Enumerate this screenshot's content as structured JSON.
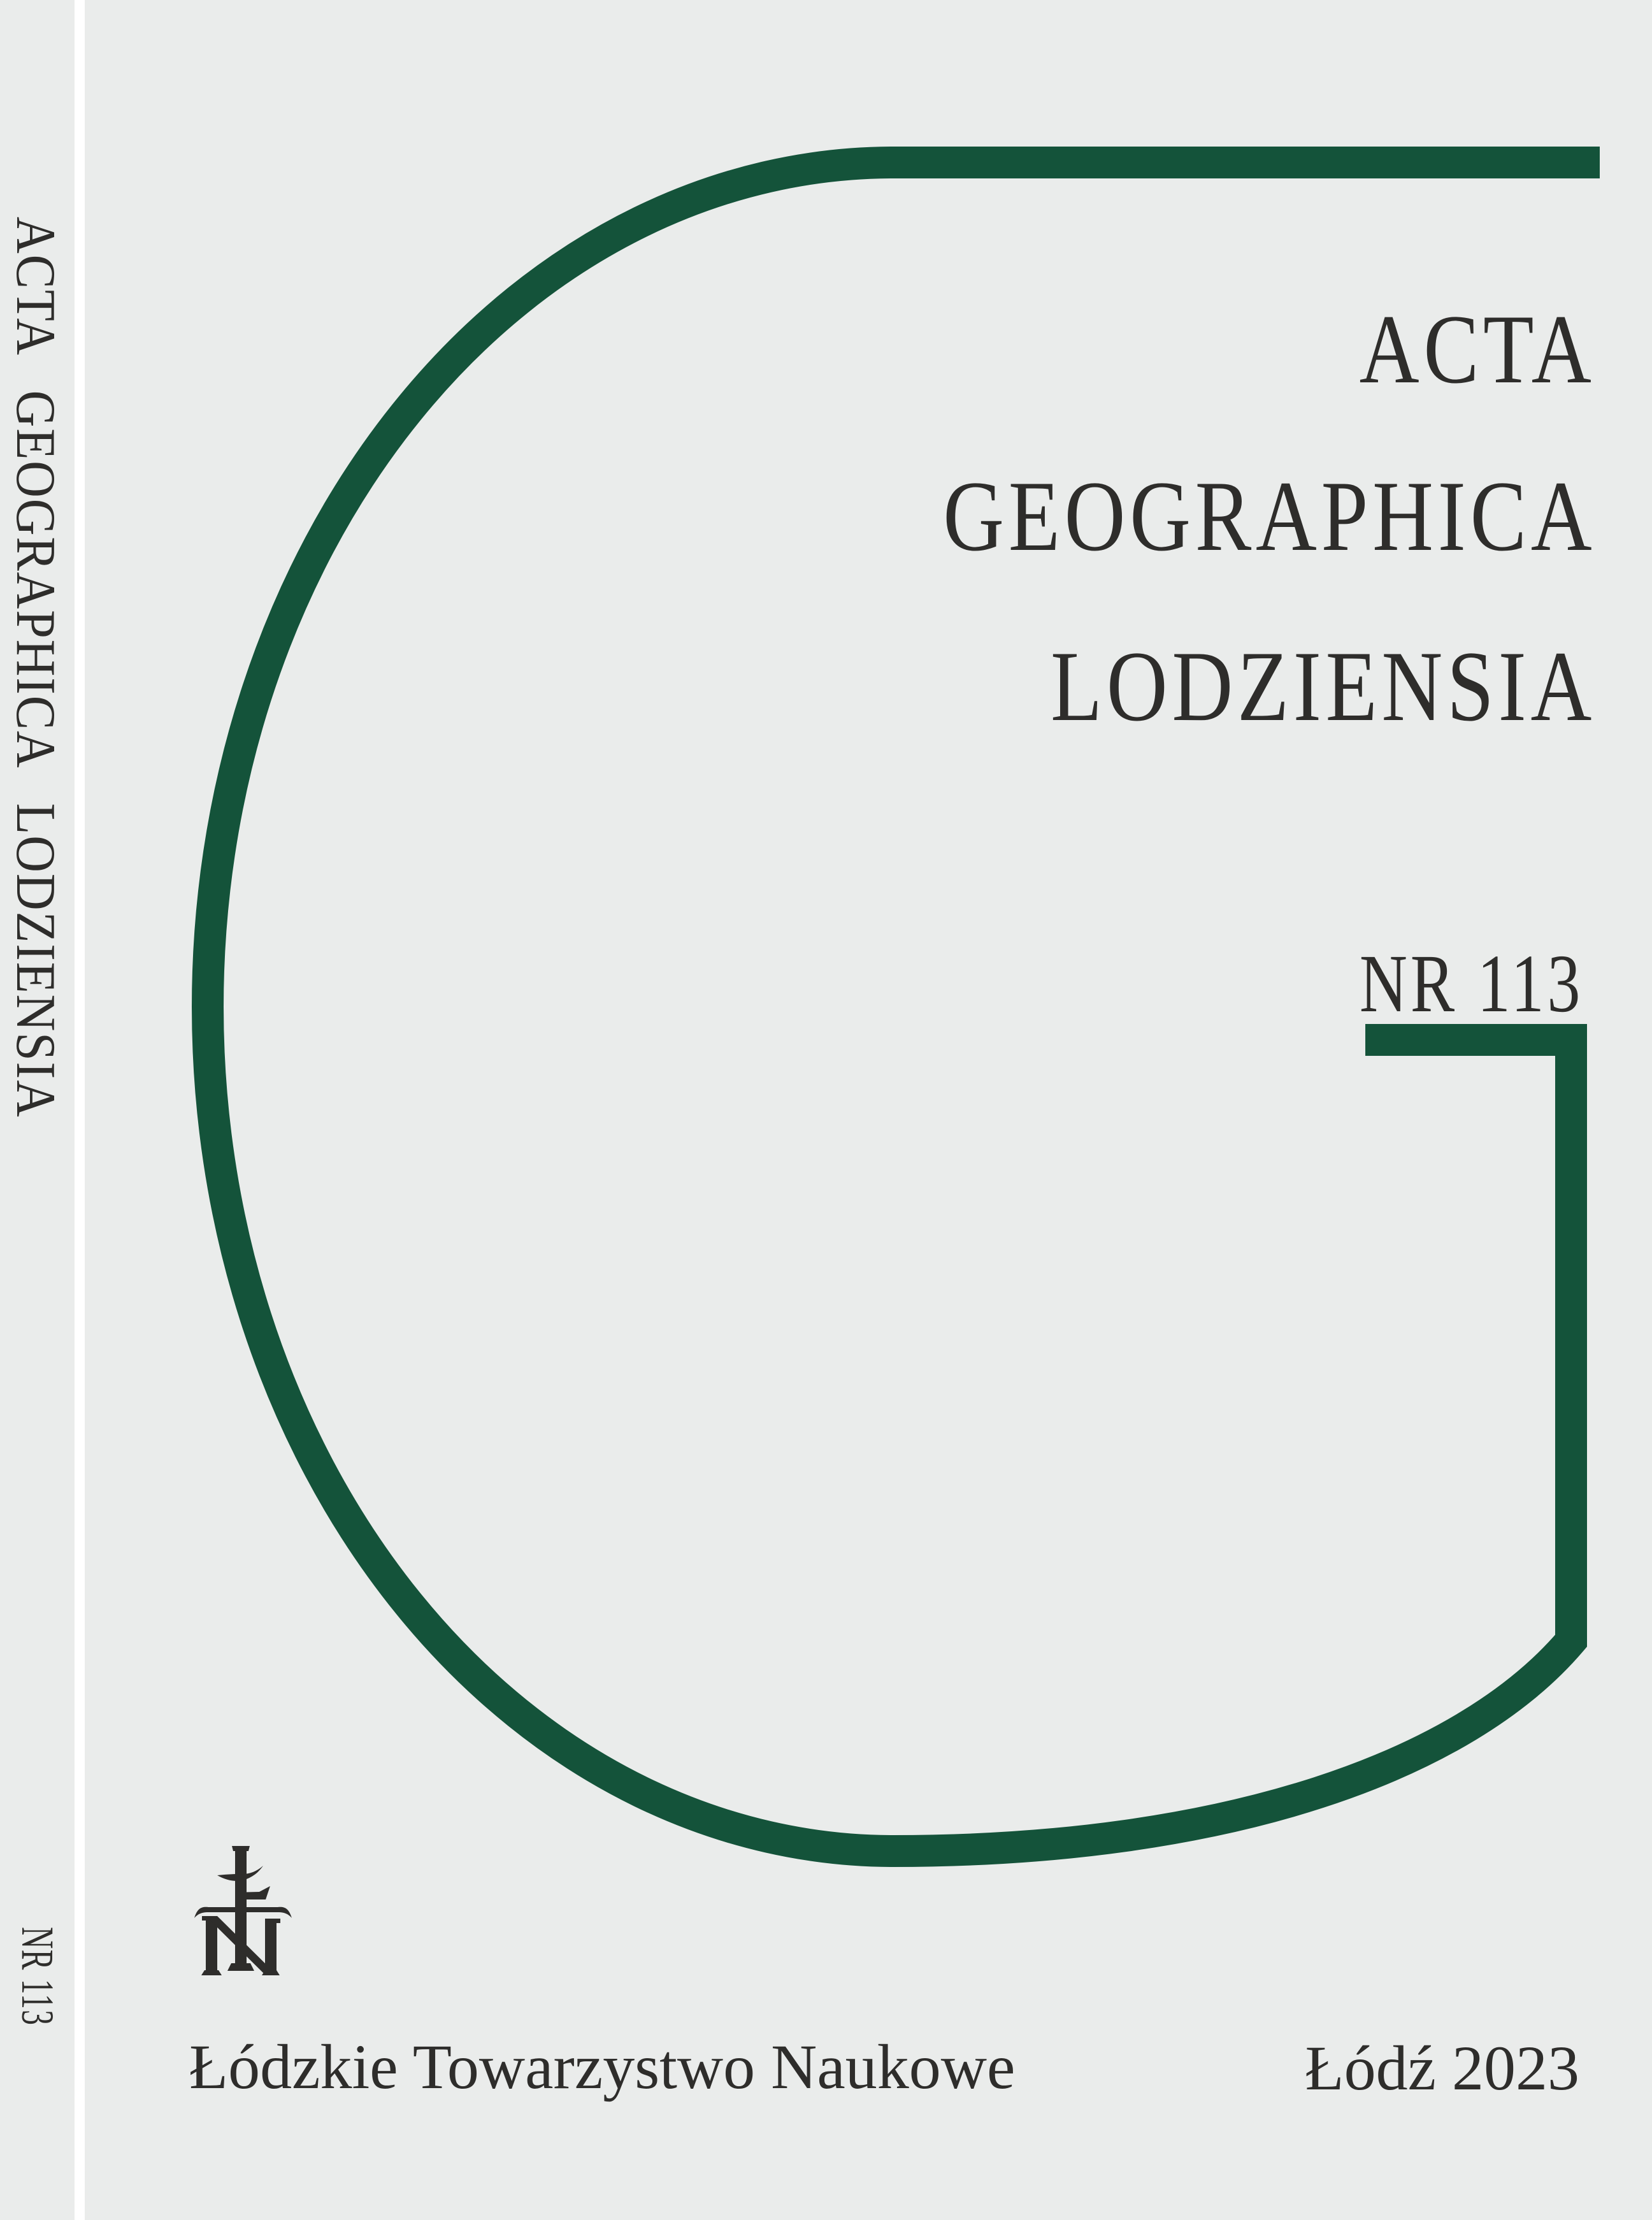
{
  "colors": {
    "green": "#14533A",
    "ink": "#2e2d2b",
    "cover_bg": "#eaeceb",
    "gutter": "#ffffff"
  },
  "spine": {
    "title": "ACTA GEOGRAPHICA LODZIENSIA",
    "issue": "NR 113"
  },
  "cover": {
    "title_lines": [
      "ACTA",
      "GEOGRAPHICA",
      "LODZIENSIA"
    ],
    "issue": "NR 113",
    "publisher": "Łódzkie Towarzystwo Naukowe",
    "place_year": "Łódź 2023",
    "logo_name": "ltn-monogram"
  }
}
